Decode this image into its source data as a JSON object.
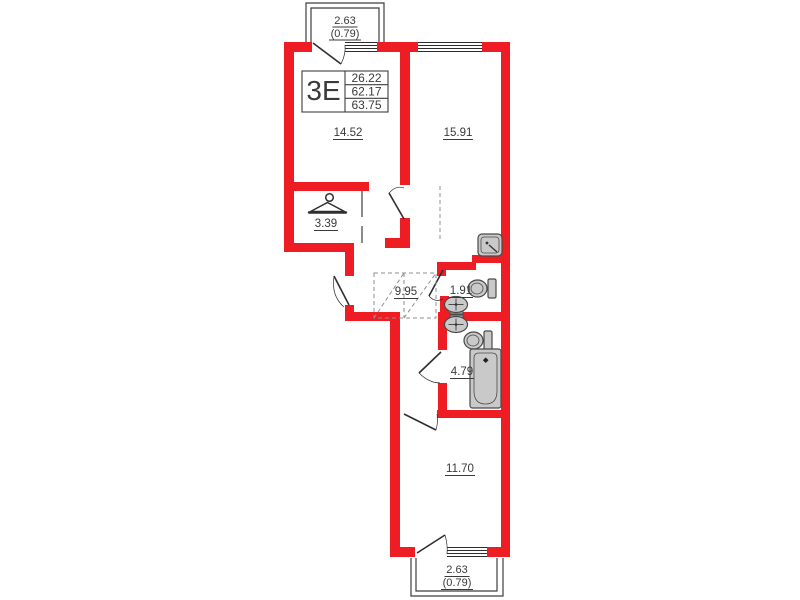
{
  "floor_plan": {
    "unit": {
      "type_label": "3Е",
      "values": [
        "26.22",
        "62.17",
        "63.75"
      ]
    },
    "areas": {
      "room_top_left": "14.52",
      "kitchen_living": "15.91",
      "wardrobe": "3.39",
      "corridor": "9.95",
      "wc": "1.91",
      "bathroom": "4.79",
      "room_bottom": "11.70"
    },
    "balconies": {
      "top": {
        "area": "2.63",
        "reduced_area": "(0.79)"
      },
      "bottom": {
        "area": "2.63",
        "reduced_area": "(0.79)"
      }
    },
    "colors": {
      "wall": "#ee1c23",
      "outline": "#3e3e3e",
      "fixture_fill": "#c9c9c9",
      "text": "#3a3a3a"
    }
  }
}
